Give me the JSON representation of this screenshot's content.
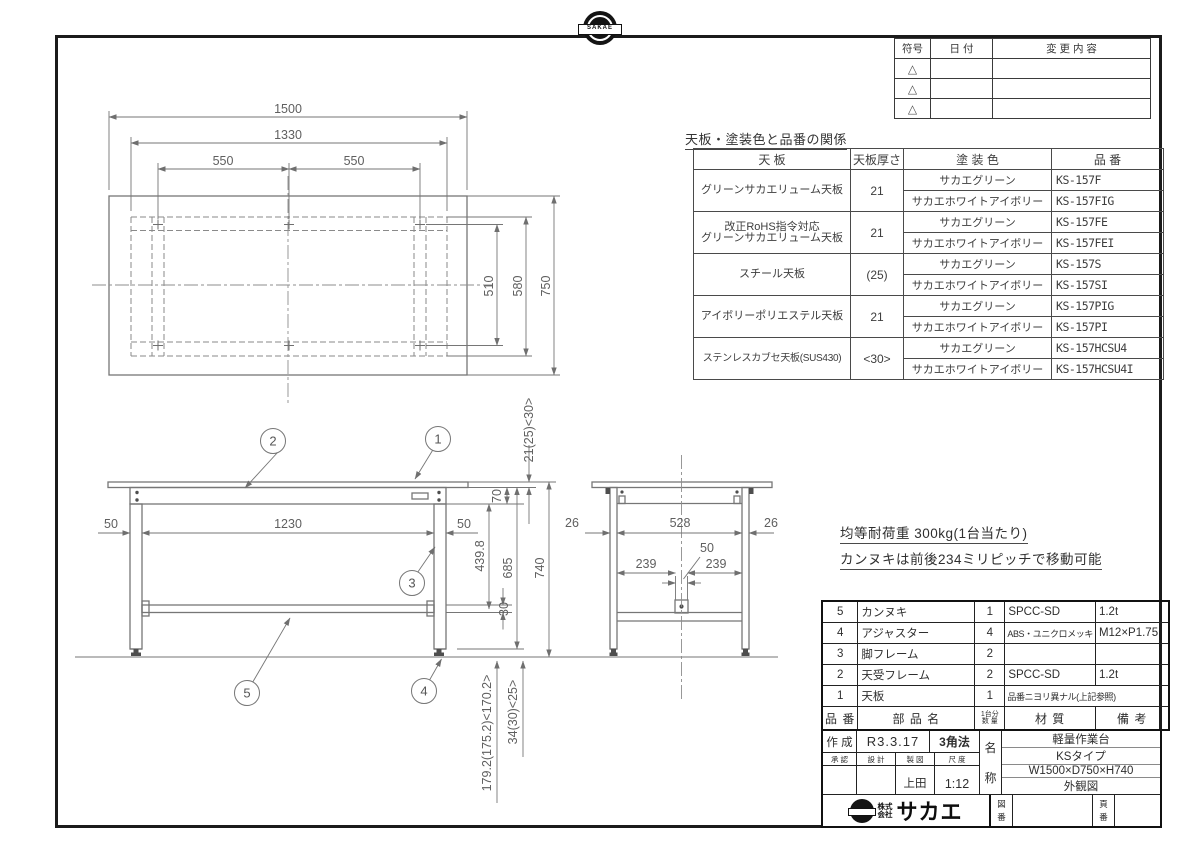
{
  "frame": {
    "logo_text": "SAKAE"
  },
  "revision_table": {
    "col_symbol": "符号",
    "col_date": "日  付",
    "col_change": "変 更 内 容",
    "row_symbol": "△"
  },
  "finish_table": {
    "title": "天板・塗装色と品番の関係",
    "col_top": "天  板",
    "col_thickness": "天板厚さ",
    "col_color": "塗  装  色",
    "col_number": "品  番",
    "groups": [
      {
        "top": "グリーンサカエリューム天板",
        "top2": "",
        "thickness": "21",
        "variants": [
          {
            "color": "サカエグリーン",
            "number": "KS-157F"
          },
          {
            "color": "サカエホワイトアイボリー",
            "number": "KS-157FIG"
          }
        ]
      },
      {
        "top": "改正RoHS指令対応",
        "top2": "グリーンサカエリューム天板",
        "thickness": "21",
        "variants": [
          {
            "color": "サカエグリーン",
            "number": "KS-157FE"
          },
          {
            "color": "サカエホワイトアイボリー",
            "number": "KS-157FEI"
          }
        ]
      },
      {
        "top": "スチール天板",
        "top2": "",
        "thickness": "(25)",
        "variants": [
          {
            "color": "サカエグリーン",
            "number": "KS-157S"
          },
          {
            "color": "サカエホワイトアイボリー",
            "number": "KS-157SI"
          }
        ]
      },
      {
        "top": "アイボリーポリエステル天板",
        "top2": "",
        "thickness": "21",
        "variants": [
          {
            "color": "サカエグリーン",
            "number": "KS-157PIG"
          },
          {
            "color": "サカエホワイトアイボリー",
            "number": "KS-157PI"
          }
        ]
      },
      {
        "top": "ステンレスカブセ天板(SUS430)",
        "top2": "",
        "thickness": "<30>",
        "variants": [
          {
            "color": "サカエグリーン",
            "number": "KS-157HCSU4"
          },
          {
            "color": "サカエホワイトアイボリー",
            "number": "KS-157HCSU4I"
          }
        ]
      }
    ]
  },
  "notes": {
    "line1": "均等耐荷重  300kg(1台当たり)",
    "line2": "カンヌキは前後234ミリピッチで移動可能"
  },
  "bom": {
    "header": {
      "number": "品 番",
      "name": "部  品  名",
      "qty1": "1台分",
      "qty2": "数 量",
      "material": "材    質",
      "remarks": "備    考"
    },
    "rows": [
      {
        "no": "5",
        "name": "カンヌキ",
        "qty": "1",
        "material": "SPCC-SD",
        "remarks": "1.2t"
      },
      {
        "no": "4",
        "name": "アジャスター",
        "qty": "4",
        "material": "ABS・ユニクロメッキ",
        "remarks": "M12×P1.75"
      },
      {
        "no": "3",
        "name": "脚フレーム",
        "qty": "2",
        "material": "",
        "remarks": ""
      },
      {
        "no": "2",
        "name": "天受フレーム",
        "qty": "2",
        "material": "SPCC-SD",
        "remarks": "1.2t"
      },
      {
        "no": "1",
        "name": "天板",
        "qty": "1",
        "material": "品番ニヨリ異ナル(上記参照)",
        "remarks": ""
      }
    ]
  },
  "title_block": {
    "created_label": "作 成",
    "created_value": "R3.3.17",
    "projection": "3角法",
    "approved_label": "承  認",
    "design_label": "設  計",
    "draft_label": "製  図",
    "scale_label": "尺  度",
    "draft_value": "上田",
    "scale_value": "1:12",
    "name_label_1": "名",
    "name_label_2": "称",
    "name_line1": "軽量作業台",
    "name_line2": "KSタイプ",
    "name_line3": "W1500×D750×H740",
    "name_line4": "外観図",
    "company_prefix_1": "株式",
    "company_prefix_2": "会社",
    "company_name": "サカエ",
    "drawing_no_label_1": "図",
    "drawing_no_label_2": "番",
    "page_no_label_1": "頁",
    "page_no_label_2": "番"
  },
  "drawing": {
    "line_color": "#7c7c7c",
    "plan": {
      "d1500": "1500",
      "d1330": "1330",
      "d550l": "550",
      "d550r": "550",
      "d510": "510",
      "d580": "580",
      "d750": "750"
    },
    "front": {
      "d50l": "50",
      "d1230": "1230",
      "d50r": "50",
      "d21": "21(25)<30>",
      "d70": "70",
      "d4398": "439.8",
      "d685": "685",
      "d740": "740",
      "d30": "30",
      "d179": "179.2(175.2)<170.2>",
      "d34": "34(30)<25>"
    },
    "side": {
      "d26l": "26",
      "d528": "528",
      "d26r": "26",
      "d50": "50",
      "d239l": "239",
      "d239r": "239"
    },
    "balloons": {
      "b1": "1",
      "b2": "2",
      "b3": "3",
      "b4": "4",
      "b5": "5"
    }
  }
}
